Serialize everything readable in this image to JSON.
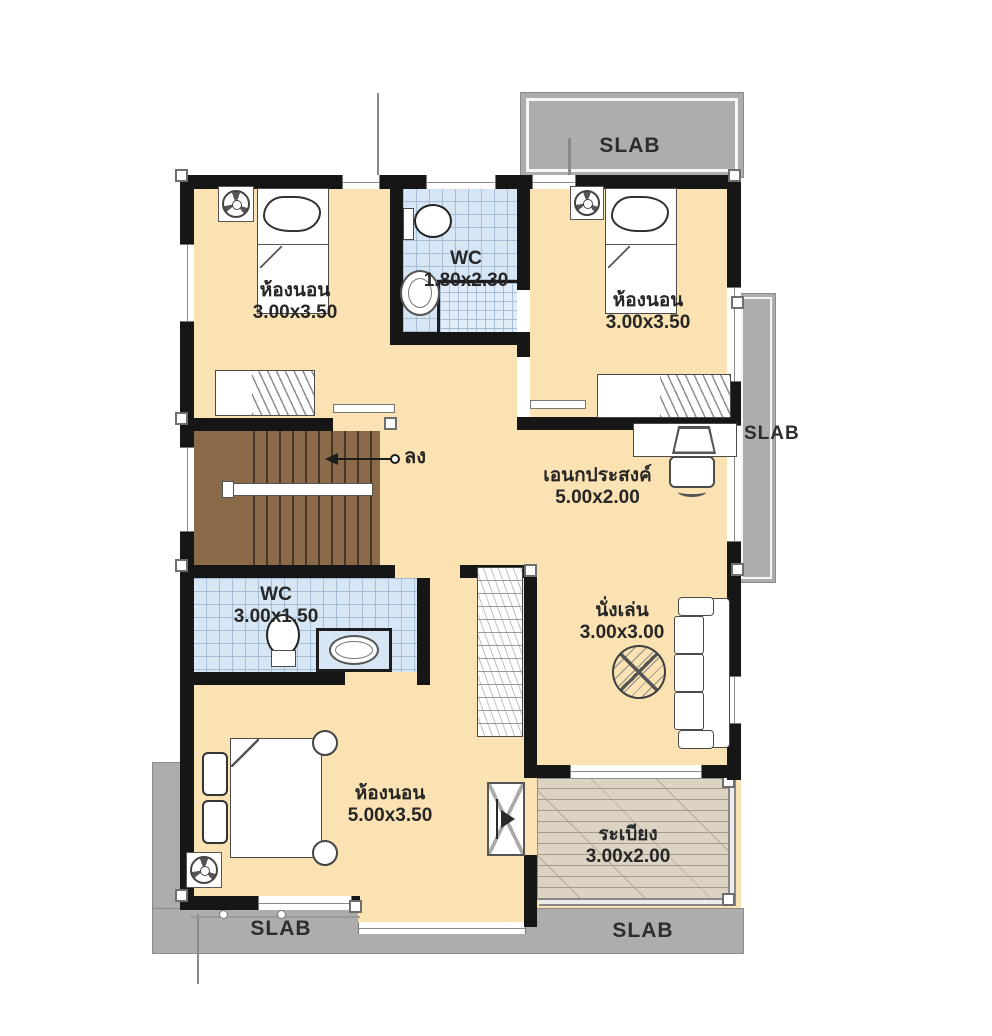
{
  "slabs": {
    "top": "SLAB",
    "right": "SLAB",
    "bottom_left": "SLAB",
    "bottom_right": "SLAB"
  },
  "stairs": {
    "down_label": "ลง"
  },
  "rooms": {
    "bedroom_top_left": {
      "name": "ห้องนอน",
      "size": "3.00x3.50"
    },
    "wc_top": {
      "name": "WC",
      "size": "1.80x2.30"
    },
    "bedroom_top_right": {
      "name": "ห้องนอน",
      "size": "3.00x3.50"
    },
    "multipurpose": {
      "name": "เอนกประสงค์",
      "size": "5.00x2.00"
    },
    "wc_middle": {
      "name": "WC",
      "size": "3.00x1.50"
    },
    "living": {
      "name": "นั่งเล่น",
      "size": "3.00x3.00"
    },
    "bedroom_master": {
      "name": "ห้องนอน",
      "size": "5.00x3.50"
    },
    "balcony": {
      "name": "ระเบียง",
      "size": "3.00x2.00"
    }
  },
  "colors": {
    "floor": "#fbe2b2",
    "wall": "#161616",
    "stairs_wood": "#8a6a48",
    "wc_tile": "#d6e6f4",
    "slab_gray": "#adadad",
    "balcony_wood": "#dcd3c2"
  }
}
